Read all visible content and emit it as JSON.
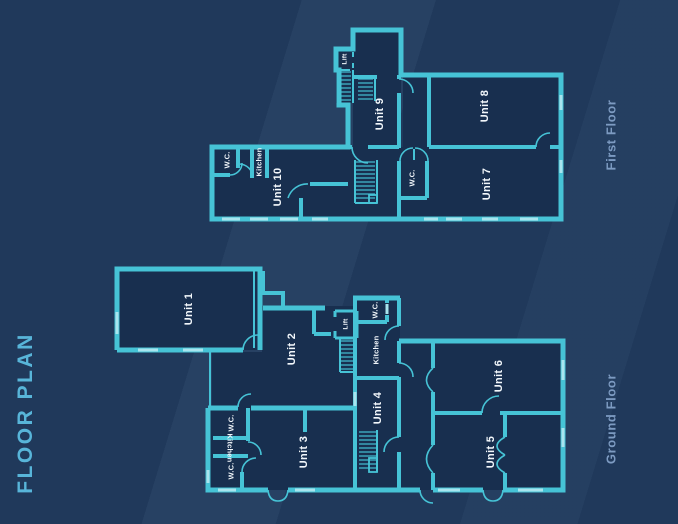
{
  "title": "FLOOR PLAN",
  "colors": {
    "background": "#20395b",
    "wall": "#46c3d6",
    "wall_light": "#a9e4ee",
    "room_fill": "#182f4f",
    "title_text": "#58b5d9",
    "floor_label_text": "#7d9bc2",
    "room_label_text": "#f2f7fb"
  },
  "first_floor": {
    "label": "First Floor",
    "rooms": {
      "lift": "Lift",
      "unit_9": "Unit 9",
      "unit_8": "Unit 8",
      "unit_7": "Unit 7",
      "wc": "W.C.",
      "unit_10": "Unit 10",
      "wc_left": "W.C.",
      "kitchen": "Kitchen"
    }
  },
  "ground_floor": {
    "label": "Ground Floor",
    "rooms": {
      "unit_1": "Unit 1",
      "unit_2": "Unit 2",
      "lift": "Lift",
      "wc_top": "W.C.",
      "kitchen": "Kitchen",
      "unit_4": "Unit 4",
      "wc_mid": "W.C.",
      "kitchen_left": "Kitchen",
      "wc_bottom": "W.C.",
      "unit_3": "Unit 3",
      "unit_6": "Unit 6",
      "unit_5": "Unit 5"
    }
  }
}
